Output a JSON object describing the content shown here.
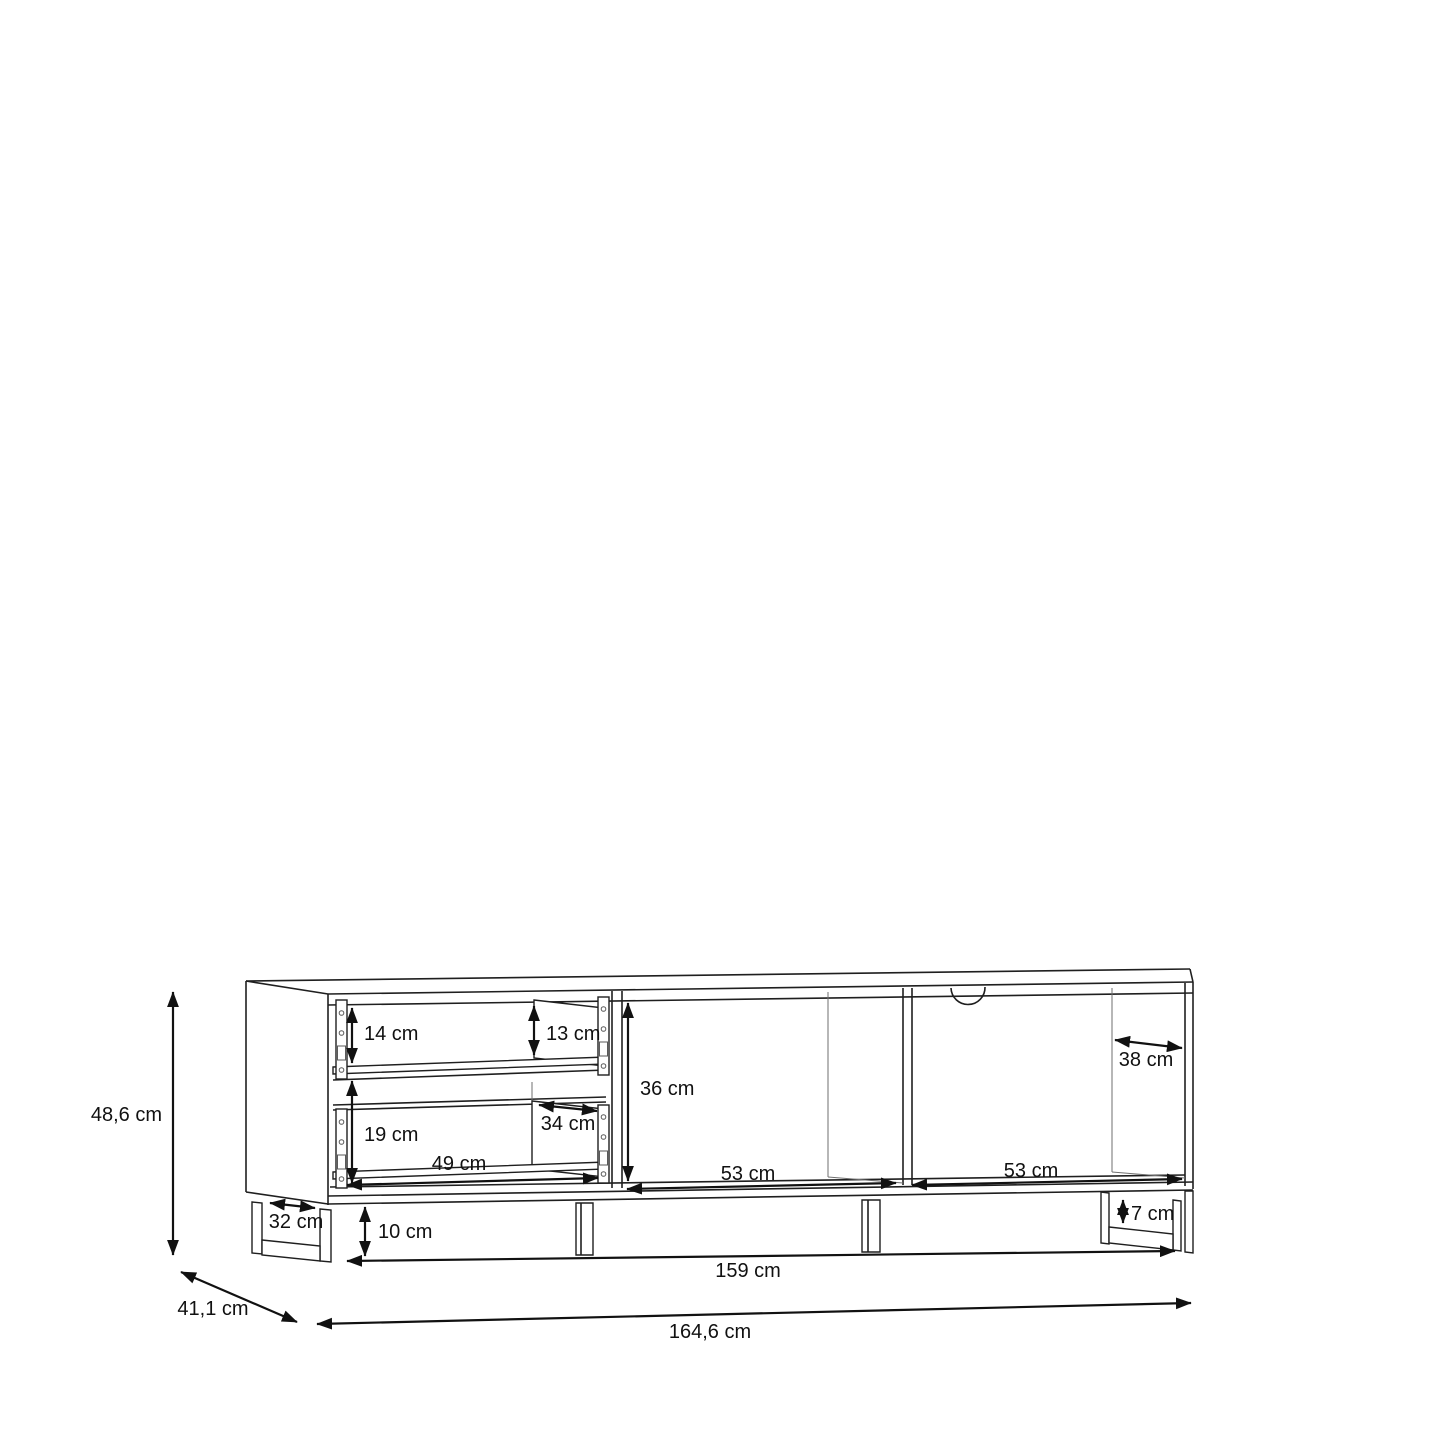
{
  "diagram": {
    "type": "furniture-dimension-drawing",
    "subject": "TV lowboard with two open drawers, two open shelf compartments, cable hole and four legs",
    "unit": "cm",
    "dimensions": {
      "overall_height": {
        "label": "48,6 cm",
        "value_cm": 48.6
      },
      "overall_depth": {
        "label": "41,1 cm",
        "value_cm": 41.1
      },
      "overall_width": {
        "label": "164,6 cm",
        "value_cm": 164.6
      },
      "base_width": {
        "label": "159 cm",
        "value_cm": 159
      },
      "leg_height": {
        "label": "10 cm",
        "value_cm": 10
      },
      "left_leg_depth": {
        "label": "32 cm",
        "value_cm": 32
      },
      "right_leg_inner_height": {
        "label": "7 cm",
        "value_cm": 7
      },
      "top_drawer_front_height": {
        "label": "14 cm",
        "value_cm": 14
      },
      "top_drawer_rear_height": {
        "label": "13 cm",
        "value_cm": 13
      },
      "bottom_drawer_height": {
        "label": "19 cm",
        "value_cm": 19
      },
      "drawer_inner_depth": {
        "label": "34 cm",
        "value_cm": 34
      },
      "drawer_inner_width": {
        "label": "49 cm",
        "value_cm": 49
      },
      "shelf_inner_height": {
        "label": "36 cm",
        "value_cm": 36
      },
      "middle_shelf_width": {
        "label": "53 cm",
        "value_cm": 53
      },
      "right_shelf_width": {
        "label": "53 cm",
        "value_cm": 53
      },
      "shelf_inner_depth": {
        "label": "38 cm",
        "value_cm": 38
      }
    }
  }
}
